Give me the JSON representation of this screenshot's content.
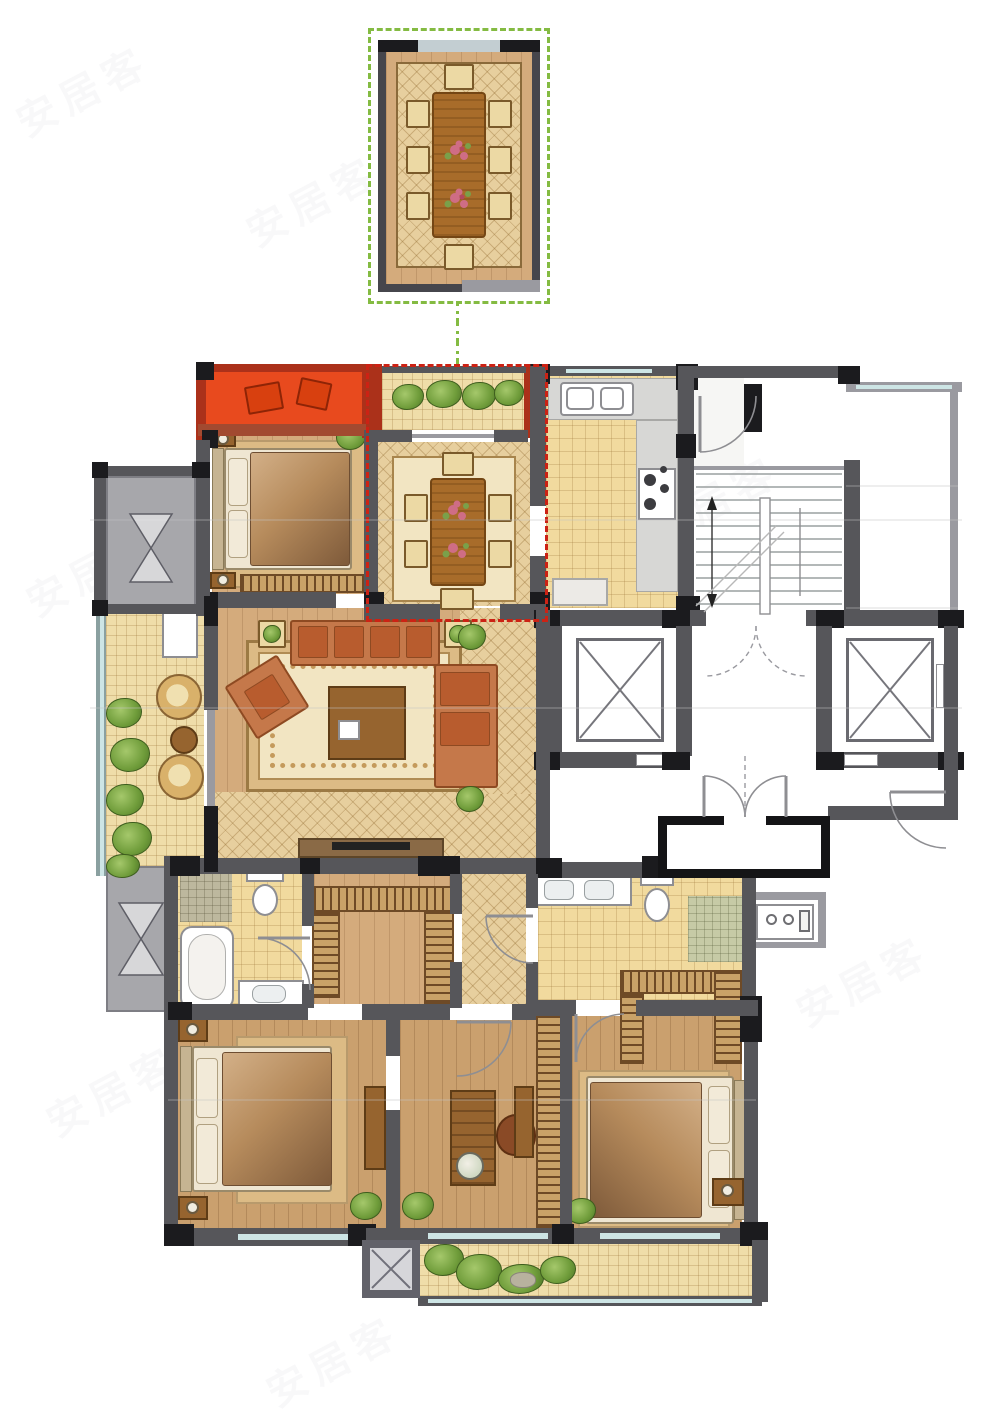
{
  "watermark": {
    "text": "安居客"
  },
  "highlights": {
    "detail_inset_border": "#84bb42",
    "selected_room_border": "#cc2214",
    "selected_bay_fill": "#e84a1e"
  },
  "colors": {
    "wall": "#56565a",
    "wallDark": "#1b1b1e",
    "wallLight": "#9a9aa0",
    "wallRed": "#a24a30",
    "orange": "#e84a1e",
    "orangeDark": "#ab311a",
    "red": "#cc2214",
    "green": "#84bb42",
    "wood": "#d4ab7c",
    "wood2": "#caa06e",
    "tile": "#f1da9e",
    "lattice": "#e7cf9e",
    "balcony": "#efdda9",
    "rugBase": "#dcbb85",
    "rugField": "#f2e5c2",
    "counter": "#d7d7d5",
    "fixture": "#ffffff",
    "fixtureLine": "#8e8e92",
    "glazing": "#cde5e5",
    "platform": "#a7a7ab",
    "shower": "#bdb89e",
    "shower2": "#c6caa6",
    "hatchBase": "#c9a268",
    "hatchLine": "#6e4a26",
    "plant": "#6f9c3a",
    "plantLight": "#a5c86b",
    "sofa": "#c5784a",
    "sofaDark": "#8e4a22",
    "cushion": "#b85c2e",
    "tableWood": "#a86c2a",
    "tableWoodDark": "#744614",
    "chairPale": "#ecd9a4",
    "linen": "#efe6d2",
    "headboard": "#c6b492",
    "blanketA": "#d3b088",
    "blanketB": "#7e5a3a",
    "deskWood": "#96642f",
    "flower": "#cf6d85",
    "flowerDeep": "#b2485e",
    "leaf": "#7aa04a",
    "faintLine": "#c6c6c6",
    "watermark": "#9a9aa4"
  },
  "rooms": [
    "dining-detail-inset",
    "bay-window-seat",
    "bedroom-north",
    "dining-room",
    "kitchen",
    "entry-hall",
    "stairwell",
    "elevator-left",
    "elevator-right",
    "elevator-lobby",
    "entrance-vestibule",
    "living-room",
    "balcony-west",
    "ac-platform",
    "master-bathroom",
    "walk-in-closet",
    "hallway",
    "second-bathroom",
    "shower-room",
    "laundry-niche",
    "master-bedroom",
    "study",
    "bedroom-east",
    "bedroom-east-closet",
    "balcony-south",
    "service-shaft"
  ]
}
